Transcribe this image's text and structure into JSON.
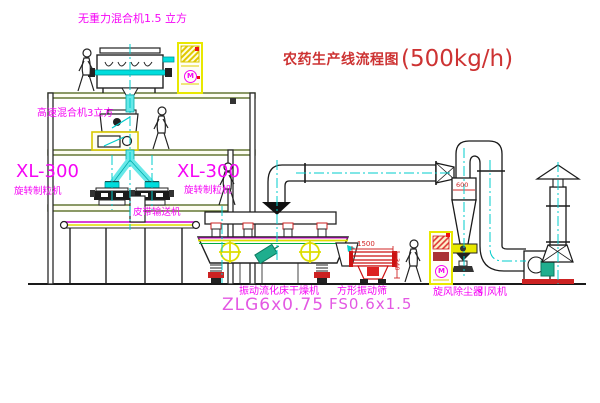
{
  "title": {
    "text": "农药生产线流程图",
    "capacity": "(500kg/h)"
  },
  "labels": {
    "gravity_mixer": "无重力混合机1.5 立方",
    "high_speed_mixer": "高速混合机3立方",
    "granulator_left_model": "XL-300",
    "granulator_left_name": "旋转制粒机",
    "granulator_right_model": "XL-300",
    "granulator_right_name": "旋转制粒机",
    "belt_conveyor": "皮带输送机",
    "fluid_bed_dryer_name": "振动流化床干燥机",
    "fluid_bed_dryer_model": "ZLG6x0.75",
    "square_sieve_name": "方形振动筛",
    "square_sieve_model": "FS0.6x1.5",
    "cyclone": "旋风除尘器",
    "induced_draft_fan": "引风机",
    "motor_mark": "M"
  },
  "dimensions": {
    "cyclone_outlet": "600",
    "sieve_length": "1500",
    "sieve_height": "340"
  },
  "colors": {
    "label_magenta": "#f505f5",
    "model_pink": "#e358e3",
    "title_red": "#cd3333",
    "dimension_red": "#d22626",
    "cabinet_yellow": "#e8e800",
    "pipe_cyan": "#00dddd",
    "centerline_cyan": "#00cccc",
    "motor_green": "#1fae8e",
    "structure_green": "#5a6e28"
  }
}
